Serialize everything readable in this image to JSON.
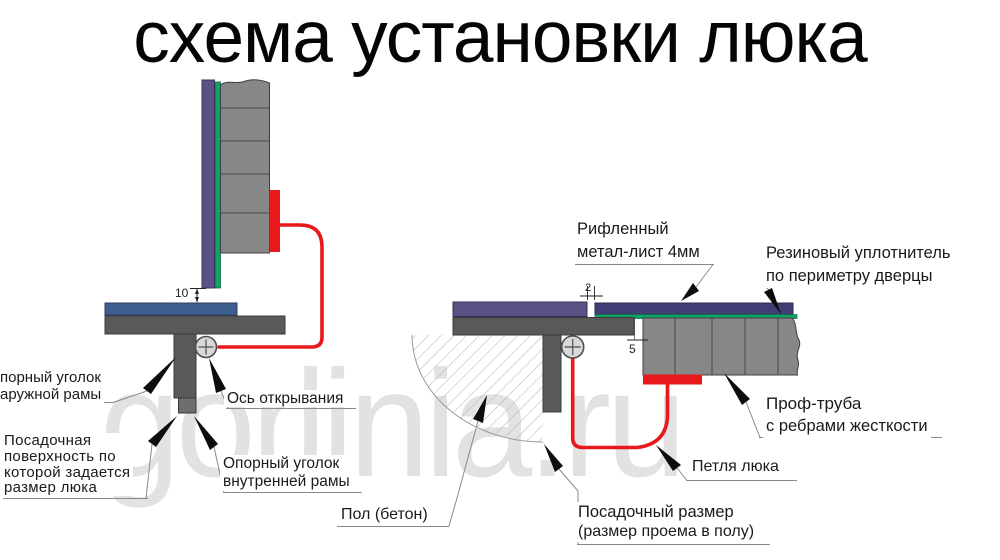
{
  "title": "схема установки люка",
  "watermark": "gorlinia.ru",
  "colors": {
    "purple": "#5c5184",
    "navy": "#403e74",
    "green": "#10a365",
    "steel_blue": "#3d5e8f",
    "frame_gray": "#595959",
    "tube_gray": "#878787",
    "red": "#e8191c"
  },
  "left_view": {
    "dim_gap": "10",
    "outer_angle": {
      "l1": "порный уголок",
      "l2": "аружной рамы"
    },
    "seating": {
      "l1": "Посадочная",
      "l2": "поверхность по",
      "l3": "которой задается",
      "l4": "размер люка"
    },
    "axis": "Ось открывания",
    "inner_angle": {
      "l1": "Опорный уголок",
      "l2": "внутренней рамы"
    }
  },
  "right_view": {
    "dim_sheet": "2",
    "dim_gap": "5",
    "sheet": {
      "l1": "Рифленный",
      "l2": "метал-лист 4мм"
    },
    "seal": {
      "l1": "Резиновый уплотнитель",
      "l2": "по периметру дверцы"
    },
    "tube": {
      "l1": "Проф-труба",
      "l2": "с ребрами жесткости"
    },
    "hinge": "Петля люка",
    "floor": "Пол (бетон)",
    "opening": {
      "l1": "Посадочный размер",
      "l2": "(размер проема в полу)"
    }
  }
}
